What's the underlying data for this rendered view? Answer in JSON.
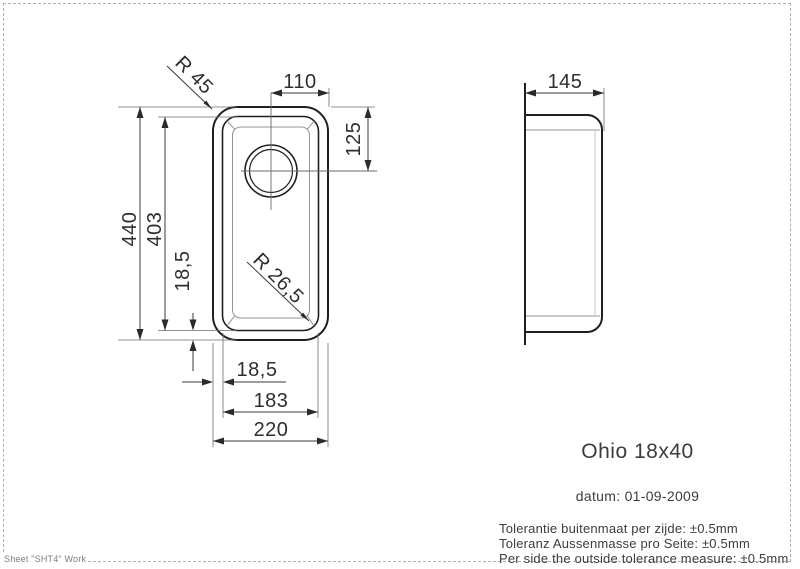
{
  "page": {
    "footer_label": "Sheet \"SHT4\" Work"
  },
  "drawing": {
    "top_view": {
      "corner_radius_outer": "R 45",
      "corner_radius_bowl": "R 26,5",
      "center_to_edge": "110",
      "drain_center_from_top": "125",
      "outer_length": "440",
      "bowl_length": "403",
      "rim_offset_bottom": "18,5",
      "rim_offset_left": "18,5",
      "bowl_width": "183",
      "outer_width": "220"
    },
    "side_view": {
      "depth": "145"
    }
  },
  "title_block": {
    "model_name": "Ohio 18x40",
    "date_line": "datum: 01-09-2009",
    "tolerance_lines": [
      "Tolerantie buitenmaat per zijde: ±0.5mm",
      "Toleranz Aussenmasse pro Seite: ±0.5mm",
      "Per side the outside tolerance measure: ±0.5mm"
    ]
  }
}
